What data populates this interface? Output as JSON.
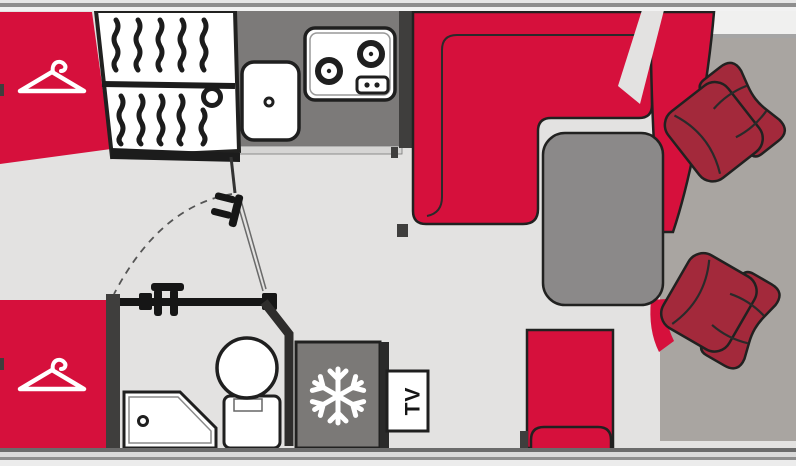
{
  "labels": {
    "tv": "TV"
  },
  "colors": {
    "floor": "#E3E2E1",
    "upholstery_red": "#D6103C",
    "cab_seat_red": "#A3293B",
    "counter_gray": "#7C7A79",
    "fridge_gray": "#7B7977",
    "table_gray": "#8B8989",
    "cab_mat": "#A9A5A1",
    "wall_dark": "#3F3E3D",
    "windshield_strip": "#F0F0EF",
    "band_dark": "#8E8E8E",
    "ledge": "#D6D5D4"
  },
  "icons": {
    "hanger": "clothes-hanger outline (white)",
    "snowflake": "six-spoke snowflake (white)",
    "burner": "ring with center dot",
    "drain": "small circle"
  },
  "furniture": [
    "wardrobe-front",
    "entry-door",
    "kitchen-counter",
    "sink",
    "hob",
    "dinette-sofa",
    "side-bench",
    "table",
    "passenger-seat",
    "driver-seat",
    "cab-mat",
    "travel-seat",
    "wardrobe-rear",
    "shower",
    "toilet",
    "bathroom-door",
    "fridge",
    "tv-box"
  ]
}
